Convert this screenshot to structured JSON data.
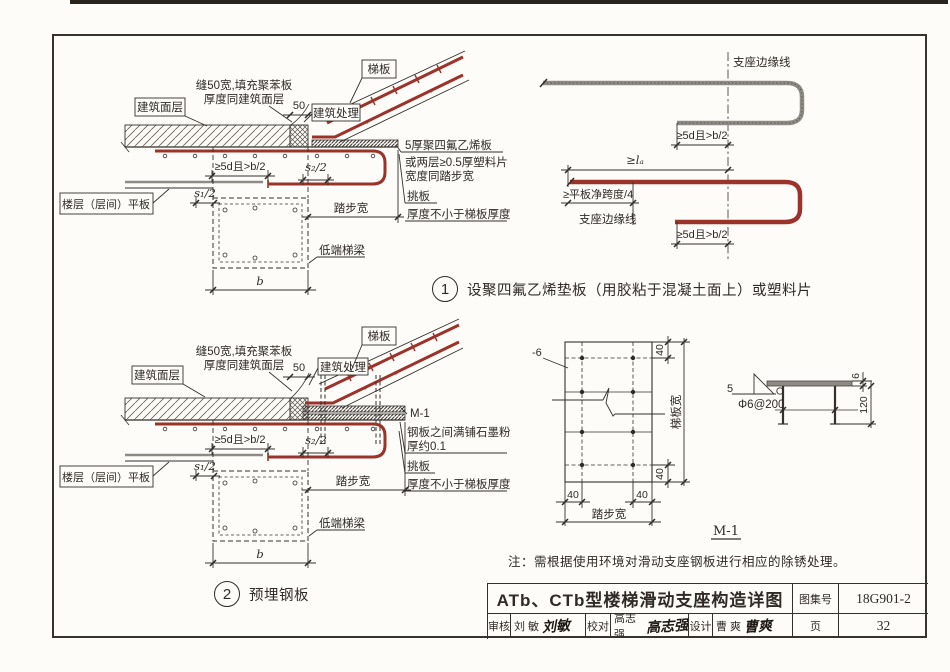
{
  "colors": {
    "rebar_red": "#9b332a",
    "bar_grey": "#8d8b84",
    "ink": "#2f2a26"
  },
  "detail1": {
    "number": "1",
    "caption": "设聚四氟乙烯垫板（用胶粘于混凝土面上）或塑料片",
    "labels": {
      "ti_ban": "梯板",
      "seam1": "缝50宽,填充聚苯板",
      "seam2": "厚度同建筑面层",
      "dim50": "50",
      "arch_treat": "建筑处理",
      "finish": "建筑面层",
      "ptfe1": "5厚聚四氟乙烯板",
      "ptfe2": "或两层≥0.5厚塑料片",
      "ptfe3": "宽度同踏步宽",
      "anchor": "≥5d且>b/2",
      "s2": "s₂/2",
      "s1": "s₁/2",
      "floor_slab": "楼层（层间）平板",
      "tread": "踏步宽",
      "tiao_ban": "挑板",
      "thick": "厚度不小于梯板厚度",
      "beam": "低端梯梁",
      "b": "b"
    }
  },
  "plan1": {
    "edge_top": "支座边缘线",
    "anchor_top": "≥5d且>b/2",
    "la": "≥lₐ",
    "quarter": "≥平板净跨度/4",
    "edge_bottom": "支座边缘线",
    "anchor_bottom": "≥5d且>b/2"
  },
  "detail2": {
    "number": "2",
    "caption": "预埋钢板",
    "labels": {
      "ti_ban": "梯板",
      "seam1": "缝50宽,填充聚苯板",
      "seam2": "厚度同建筑面层",
      "dim50": "50",
      "arch_treat": "建筑处理",
      "finish": "建筑面层",
      "m1": "M-1",
      "graphite1": "钢板之间满铺石墨粉",
      "graphite2": "厚约0.1",
      "anchor": "≥5d且>b/2",
      "s2": "s₂/2",
      "s1": "s₁/2",
      "floor_slab": "楼层（层间）平板",
      "tread": "踏步宽",
      "tiao_ban": "挑板",
      "thick": "厚度不小于梯板厚度",
      "beam": "低端梯梁",
      "b": "b"
    }
  },
  "m1plan": {
    "minus6": "-6",
    "d40": "40",
    "slab_width": "梯板宽",
    "tread": "踏步宽",
    "m1": "M-1"
  },
  "weld": {
    "w5": "5",
    "stud": "Φ6@200",
    "t6": "6",
    "len120": "120"
  },
  "note": "注：需根据使用环境对滑动支座钢板进行相应的除锈处理。",
  "titleblock": {
    "title": "ATb、CTb型楼梯滑动支座构造详图",
    "atlas_label": "图集号",
    "atlas_no": "18G901-2",
    "page_label": "页",
    "page_no": "32",
    "check_label": "审核",
    "check_name": "刘  敏",
    "check_sig": "刘敏",
    "proof_label": "校对",
    "proof_name": "高志强",
    "proof_sig": "高志强",
    "design_label": "设计",
    "design_name": "曹  爽",
    "design_sig": "曹爽"
  }
}
